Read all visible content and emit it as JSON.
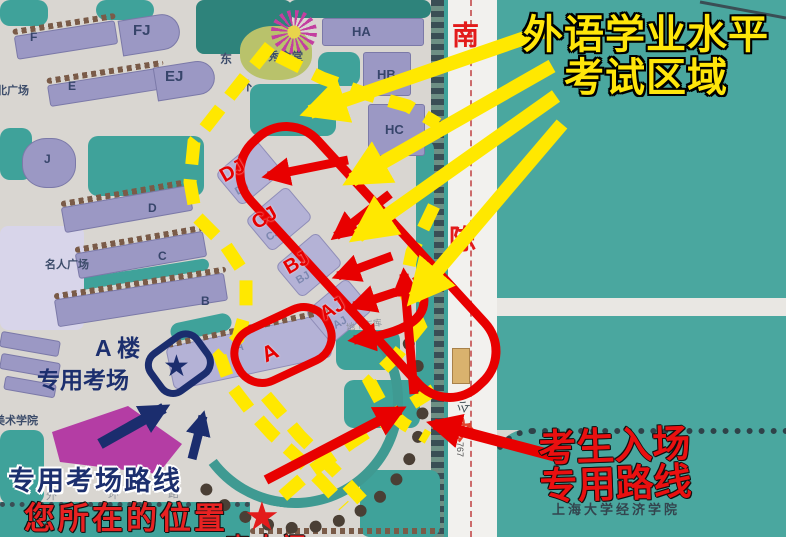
{
  "title": {
    "line1": "外语学业水平",
    "line2": "考试区域"
  },
  "entrance": {
    "line1": "考生入场",
    "line2": "专用路线"
  },
  "exam_room": {
    "line1": "A 楼",
    "line2": "专用考场"
  },
  "exam_route_label": "专用考场路线",
  "your_location_label": "您所在的位置",
  "south_gate_label": "南大门",
  "road": {
    "name_char_1": "南",
    "name_char_2": "陈",
    "gong": "公",
    "lu": "路",
    "bus_number": "767"
  },
  "campus": {
    "buildings": [
      "F",
      "FJ",
      "E",
      "EJ",
      "HA",
      "HB",
      "HC",
      "J",
      "D",
      "C",
      "B",
      "A"
    ],
    "red_labels": [
      "DJ",
      "CJ",
      "BJ",
      "AJ",
      "A"
    ],
    "ghost_labels": [
      "DJ",
      "CJ",
      "BJ",
      "AJ"
    ],
    "places": {
      "canteen": "水秀食堂",
      "north_plaza": "北广场",
      "celebrity_plaza": "名人广场",
      "art_college": "美术学院",
      "outer_ring_chars": [
        "外",
        "环",
        "路"
      ],
      "east_char": "东",
      "wai_char": "外",
      "college": "上海大学经济学院",
      "garage": "地下车库"
    }
  },
  "icons": {
    "star": "★"
  },
  "colors": {
    "yellow": "#ffe800",
    "red": "#e80000",
    "navy": "#1b2d6e",
    "teal": "#3fa29a",
    "magenta": "#b130a0"
  }
}
